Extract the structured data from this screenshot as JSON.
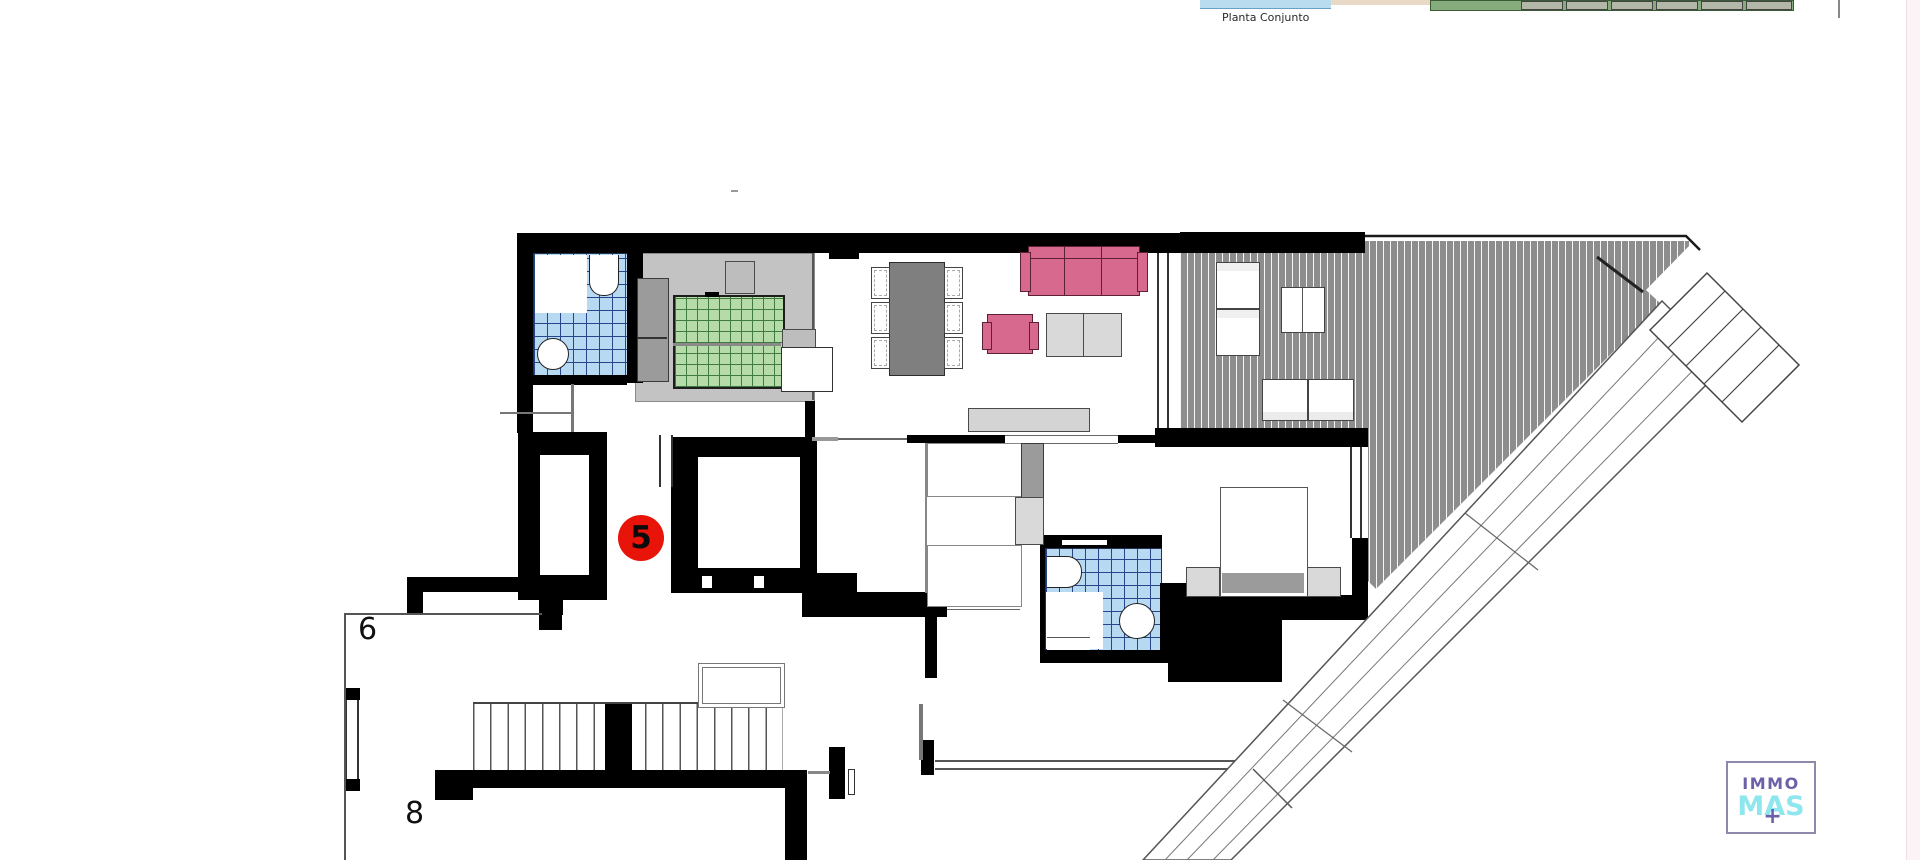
{
  "header": {
    "thumbnail_caption": "Planta Conjunto"
  },
  "plan": {
    "unit_badge": "5",
    "labels": {
      "left_terrace": "6",
      "lower_terrace": "8"
    }
  },
  "logo": {
    "line1": "IMMO",
    "line2": "MAS",
    "plus": "+"
  },
  "colors": {
    "wall": "#000000",
    "deck": "#8d8d8d",
    "tile_blue": "#b7d9f2",
    "tile_grid": "#27458b",
    "bed_green": "#b5dba8",
    "bed_green_grid": "#3f7a3f",
    "sofa_pink": "#d7688e",
    "furniture_gray": "#d9d9d9",
    "floor_gray": "#c4c3c3",
    "badge_red": "#e81309",
    "logo_purple": "#6b61a8",
    "logo_cyan": "#8ee6ef",
    "water_blue": "#b9dcee",
    "sand_beige": "#e9dac8",
    "site_green": "#86ab7c"
  }
}
